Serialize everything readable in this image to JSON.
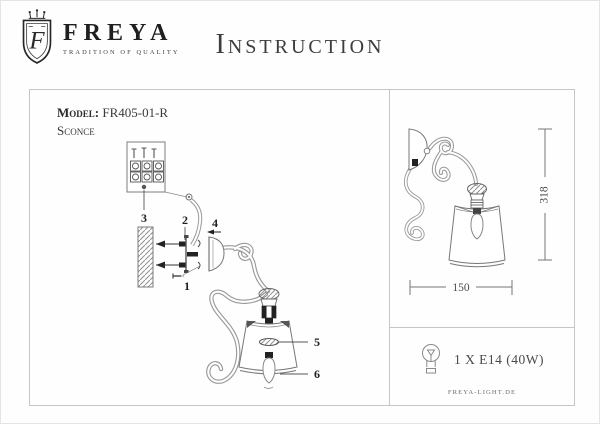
{
  "header": {
    "brand": "FREYA",
    "tagline": "TRADITION OF QUALITY",
    "title": "Instruction",
    "logo_icon": "freya-shield-crown-icon",
    "logo_letter": "F"
  },
  "left_panel": {
    "model_label": "Model:",
    "model_value": "FR405-01-R",
    "product_type": "Sconce",
    "parts": [
      "1",
      "2",
      "3",
      "4",
      "5",
      "6"
    ]
  },
  "right_panel": {
    "height_dim": "318",
    "width_dim": "150",
    "bulb_spec": "1 X E14 (40W)",
    "bulb_icon": "bulb-icon",
    "website": "FREYA-LIGHT.DE"
  },
  "colors": {
    "frame_border": "#c6c6c6",
    "drawing_line": "#8f8f8f",
    "text": "#333333"
  }
}
